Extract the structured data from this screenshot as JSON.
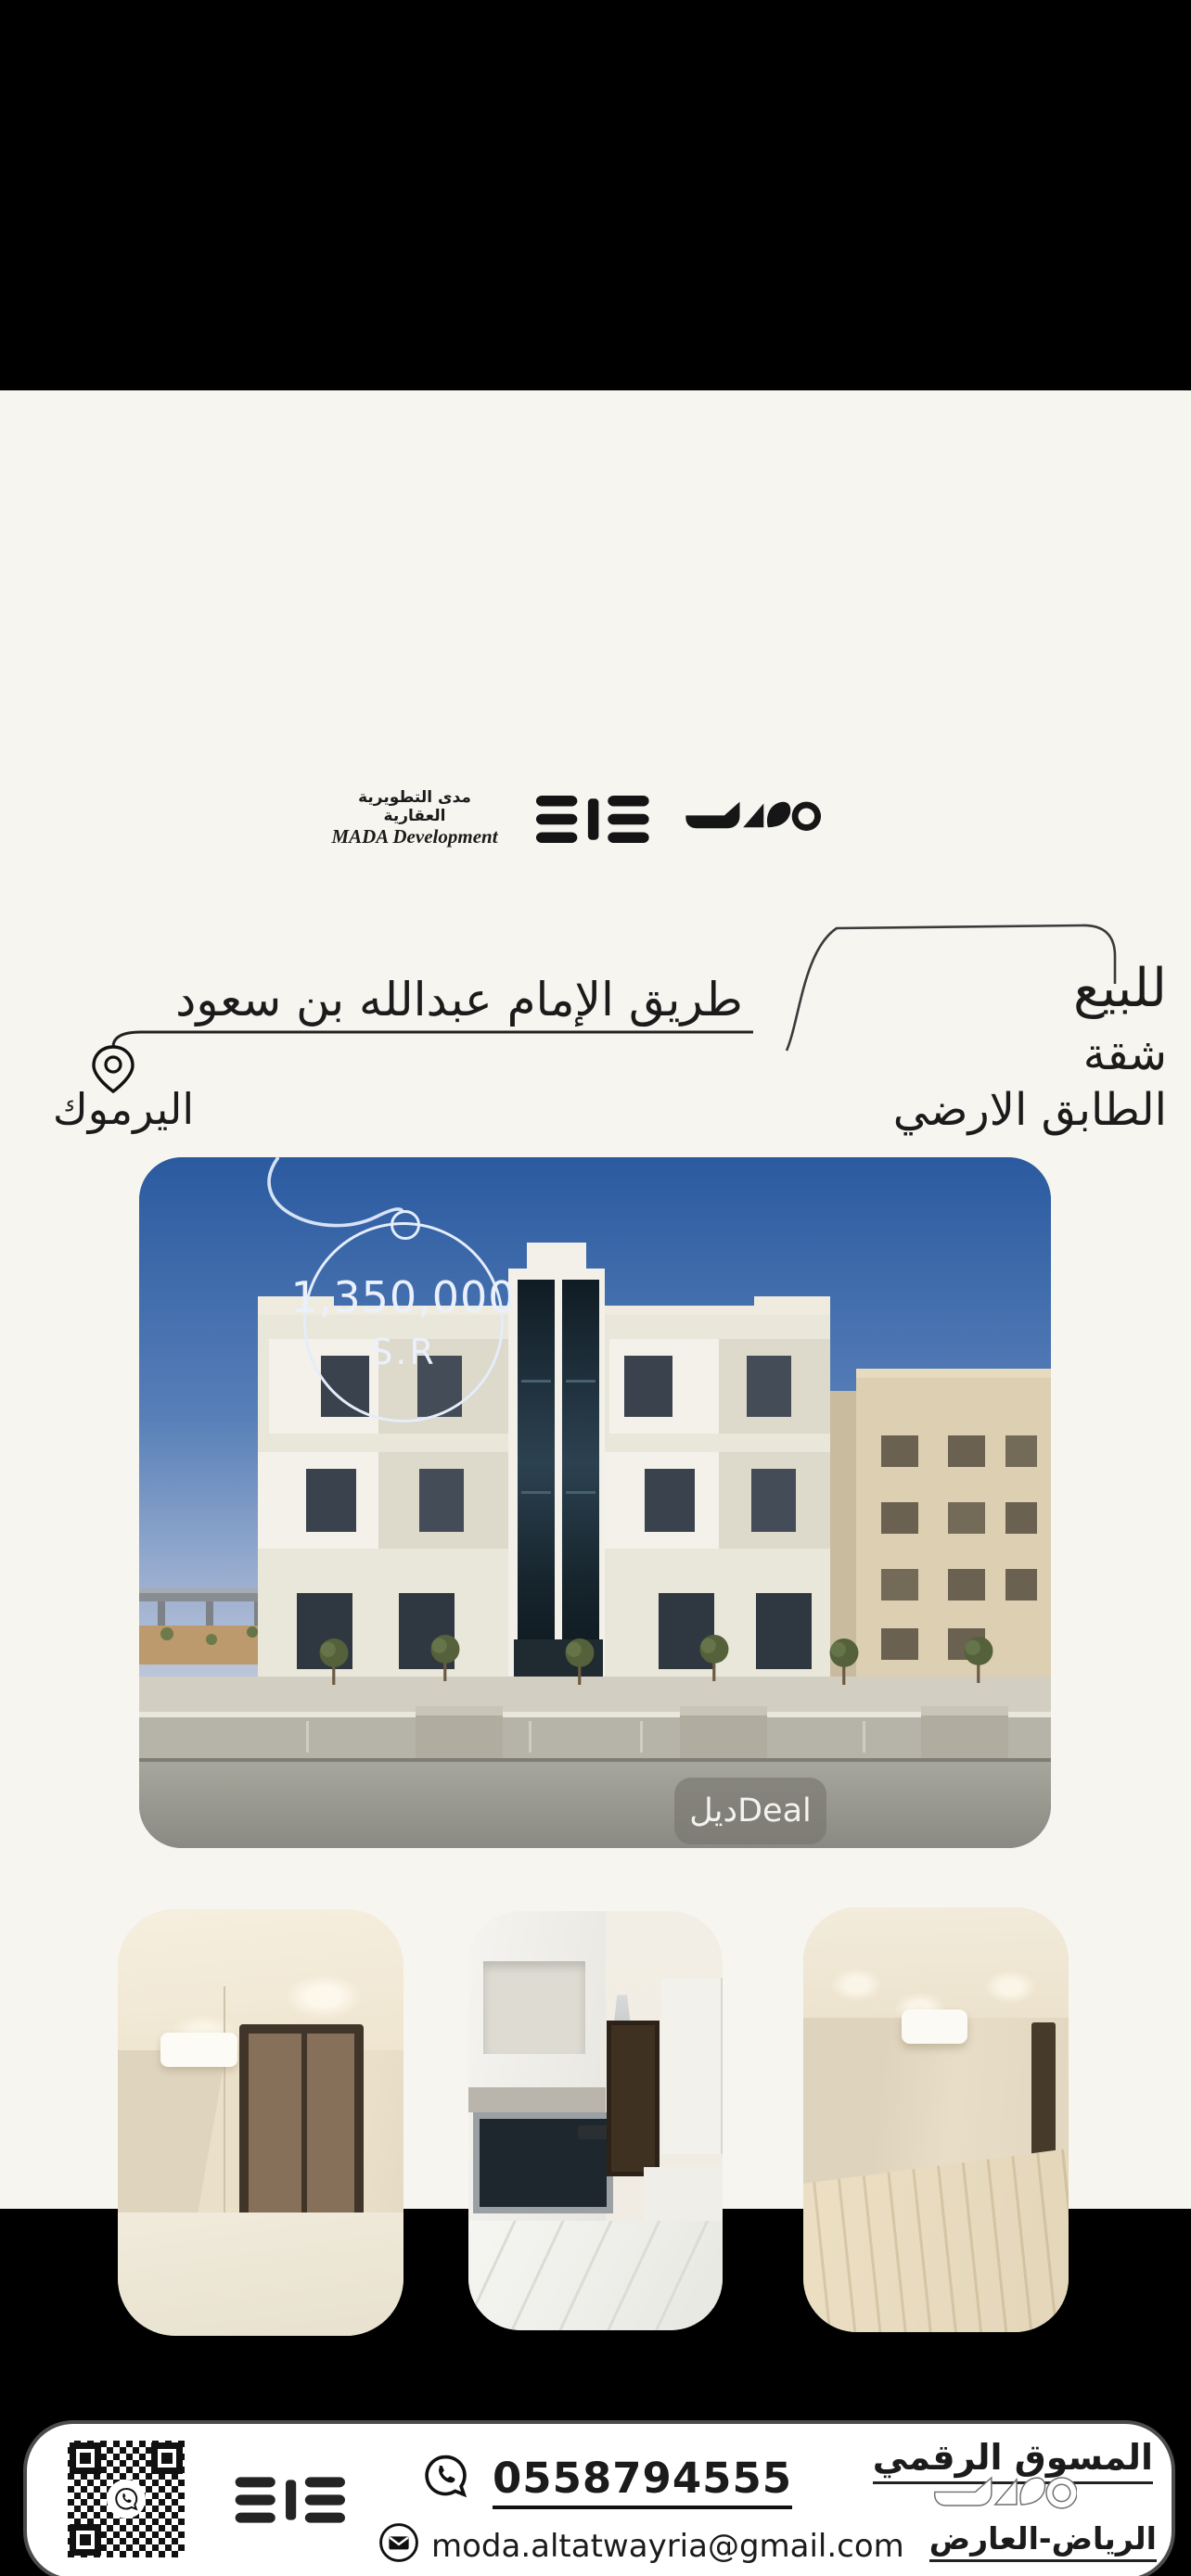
{
  "brand": {
    "name_ar": "مدى التطويرية العقارية",
    "name_en": "MADA Development"
  },
  "listing": {
    "sale_label": "للبيع",
    "property_type": "شقة",
    "floor_label": "الطابق الارضي",
    "road_label": "طريق الإمام عبدالله بن سعود",
    "district_label": "اليرموك",
    "price": "1,350,000",
    "currency_label": "S.R",
    "photo_watermark": "ديلDeal"
  },
  "contact_bar": {
    "marketer_label": "المسوق الرقمي",
    "location_label": "الرياض-العارض",
    "phone": "0558794555",
    "email": "moda.altatwayria@gmail.com"
  },
  "colors": {
    "background": "#f7f5f0",
    "band": "#000000",
    "ink": "#1b1b1b",
    "sky_top": "#2b5aa0",
    "tag_stroke": "#e4edfa"
  }
}
